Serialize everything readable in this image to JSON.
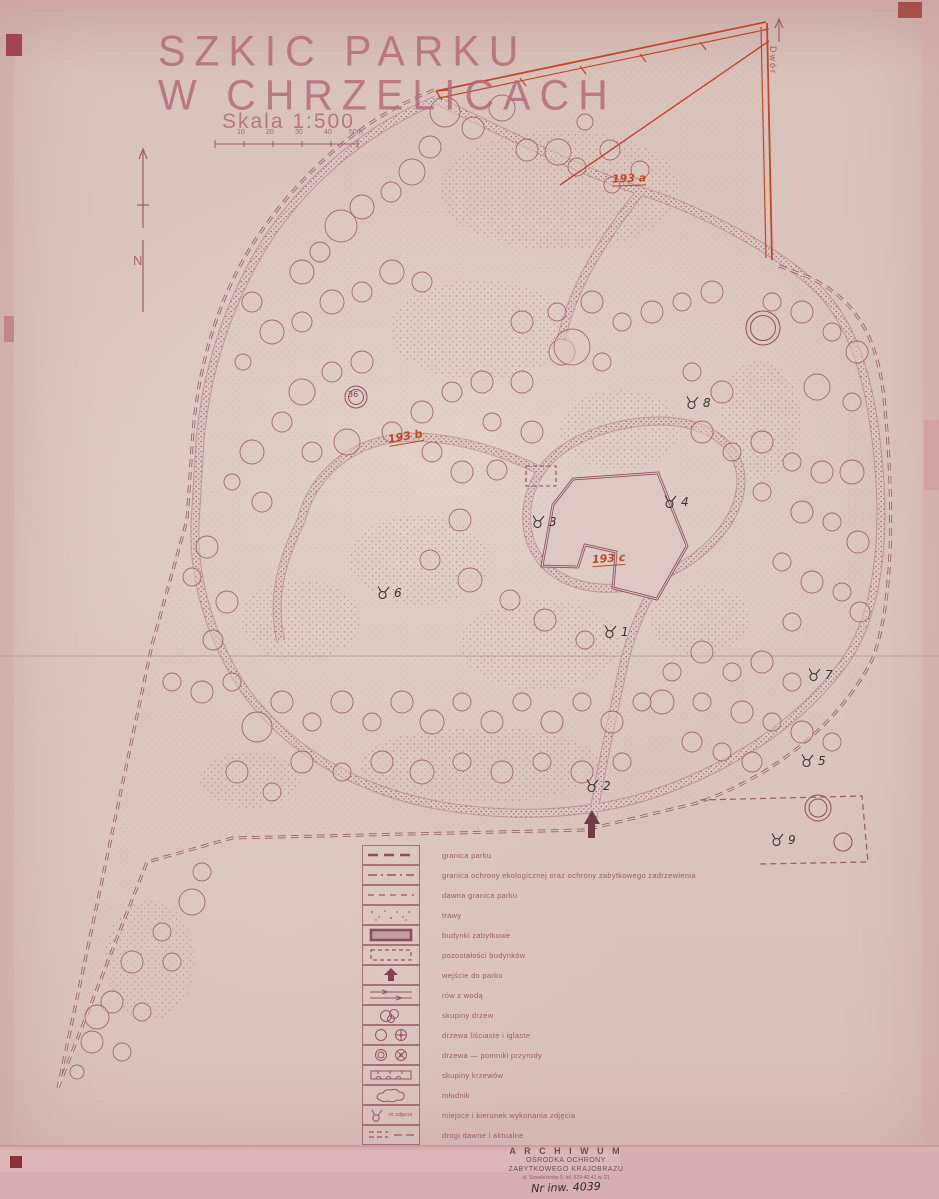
{
  "page": {
    "title_line1": "SZKIC PARKU",
    "title_line2": "W CHRZELICACH",
    "scale_label": "Skala 1:500",
    "scale_ticks": [
      "10",
      "20",
      "30",
      "40",
      "50m"
    ],
    "north_label": "N"
  },
  "map": {
    "red_area_labels": [
      "193 a",
      "193 b",
      "193 c"
    ],
    "rotated_edge_label": "Dwór",
    "tree_tag": "36",
    "photo_markers": [
      "1",
      "2",
      "3",
      "4",
      "5",
      "6",
      "7",
      "8",
      "9"
    ]
  },
  "legend": {
    "items": [
      {
        "label": "granica parku"
      },
      {
        "label": "granica ochrony ekologicznej oraz ochrony zabytkowego zadrzewienia"
      },
      {
        "label": "dawna granica parku"
      },
      {
        "label": "trawy"
      },
      {
        "label": "budynki zabytkowe"
      },
      {
        "label": "pozostałości budynków"
      },
      {
        "label": "wejście do parku"
      },
      {
        "label": "rów z wodą"
      },
      {
        "label": "skupiny drzew"
      },
      {
        "label": "drzewa liściaste i iglaste"
      },
      {
        "label": "drzewa — pomniki przyrody"
      },
      {
        "label": "skupiny krzewów"
      },
      {
        "label": "młodnik"
      },
      {
        "label": "miejsce i kierunek wykonania zdjęcia",
        "symbol_note": "nr zdjęcia"
      },
      {
        "label": "drogi dawne i aktualne"
      }
    ]
  },
  "stamp": {
    "line1": "A R C H I W U M",
    "line2": "OŚRODKA OCHRONY",
    "line3": "ZABYTKOWEGO KRAJOBRAZU",
    "line4": "ul. Szwoleżerów 9, tel. 629-40-41 w. 21",
    "handwritten": "Nr inw. 4039"
  },
  "colors": {
    "paper": "#dbc7bf",
    "ink": "#9a5866",
    "red_overlay": "#c2472a",
    "black_ink": "#3a3335",
    "pink_band": "#d9aeb1"
  }
}
